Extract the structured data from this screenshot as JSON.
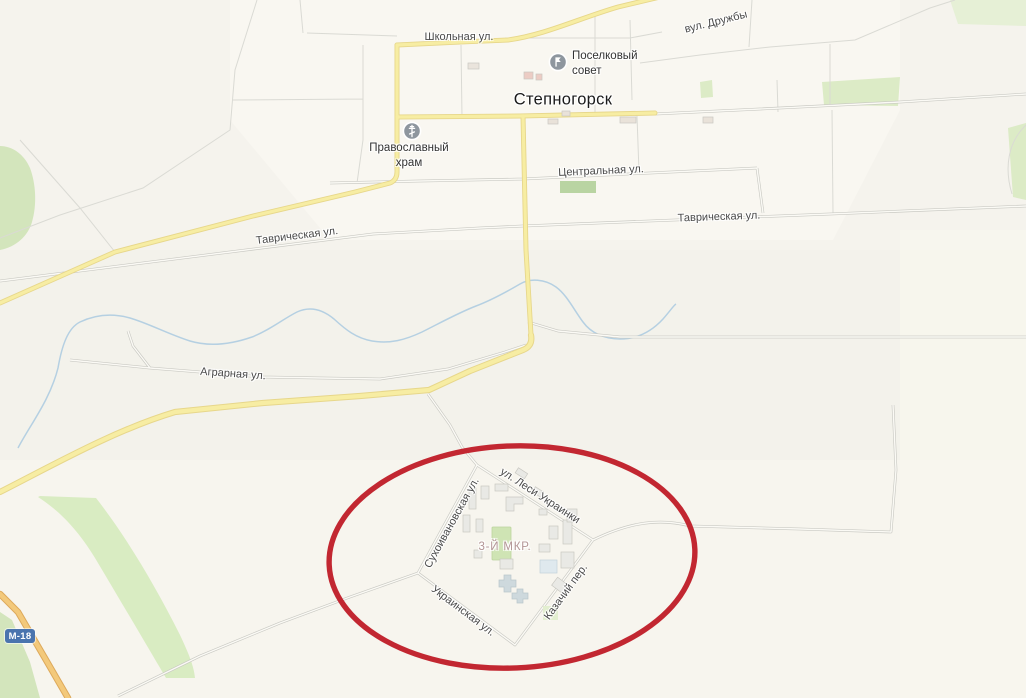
{
  "map": {
    "town_label": "Степногорск",
    "district_label": "3-Й МКР.",
    "road_badge": "М-18",
    "streets": {
      "shkolnaya": "Школьная ул.",
      "druzhby": "вул. Дружбы",
      "tsentralnaya": "Центральная ул.",
      "tavricheskaya_east": "Таврическая ул.",
      "tavricheskaya_west": "Таврическая ул.",
      "agrarnaya": "Аграрная ул.",
      "lesi_ukrainki": "ул. Леси Украинки",
      "sukhoivanovskaya": "Сухоивановская ул.",
      "ukrainskaya": "Украинская ул.",
      "kazachiy": "Казачий пер."
    },
    "pois": {
      "sovet": {
        "label": "Поселковый\nсовет",
        "icon": "administration-flag-icon"
      },
      "khram": {
        "label": "Православный\nхрам",
        "icon": "orthodox-cross-icon"
      }
    },
    "annotation": {
      "shape": "ellipse",
      "color": "#c22731"
    },
    "colors": {
      "road_yellow": "#f7eda3",
      "road_trunk_orange": "#f3c97b",
      "water_blue": "#b5d0e2",
      "greenery": "#d9eac4",
      "annotation_red": "#c22731",
      "badge_blue": "#4a74ae"
    }
  }
}
